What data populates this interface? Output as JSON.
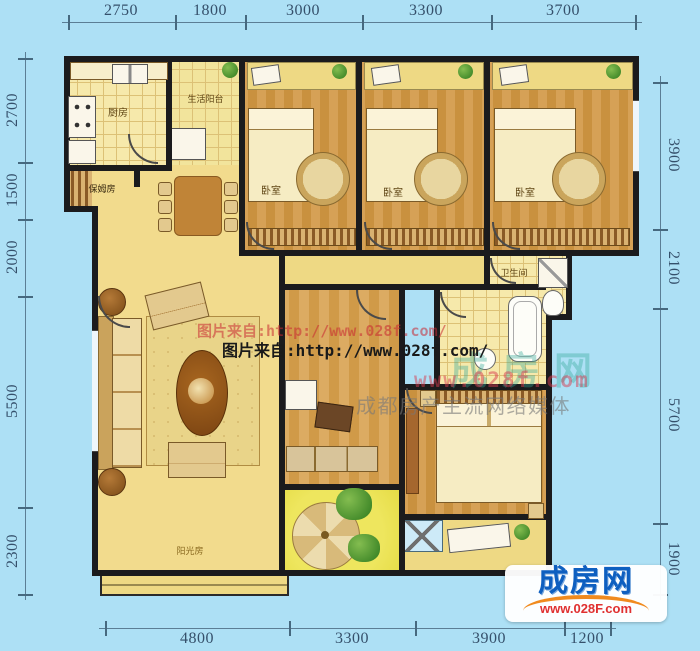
{
  "dims": {
    "top": [
      "2750",
      "1800",
      "3000",
      "3300",
      "3700"
    ],
    "left": [
      "2700",
      "1500",
      "2000",
      "5500",
      "2300"
    ],
    "right": [
      "3900",
      "2100",
      "5700",
      "1900"
    ],
    "bottom": [
      "4800",
      "3300",
      "3900",
      "1200"
    ]
  },
  "rooms": {
    "kitchen": "厨房",
    "service_balcony": "生活阳台",
    "storage": "保姆房",
    "bedroom1": "卧室",
    "bedroom2": "卧室",
    "bedroom3": "卧室",
    "bathroom": "卫生间",
    "sunroom": "阳光房"
  },
  "watermarks": {
    "source_line_red": "图片来自:http://www.028f.com/",
    "source_line_black": "图片来自:http://www.028f.com/",
    "site_name": "成房网",
    "site_url": "www.028f.com",
    "slogan": "成都房产主流网络媒体"
  },
  "logo": {
    "title": "成房网",
    "url": "www.028F.com"
  },
  "colors": {
    "background": "#ade0f5",
    "wall": "#1b1b1d",
    "floor_cream": "#f2db8d",
    "floor_wood": "#d29a4e",
    "sunroom_yellow": "#e9e04a",
    "logo_blue": "#0e5fc0",
    "logo_red": "#e03030",
    "dimension_text": "#35506b"
  }
}
